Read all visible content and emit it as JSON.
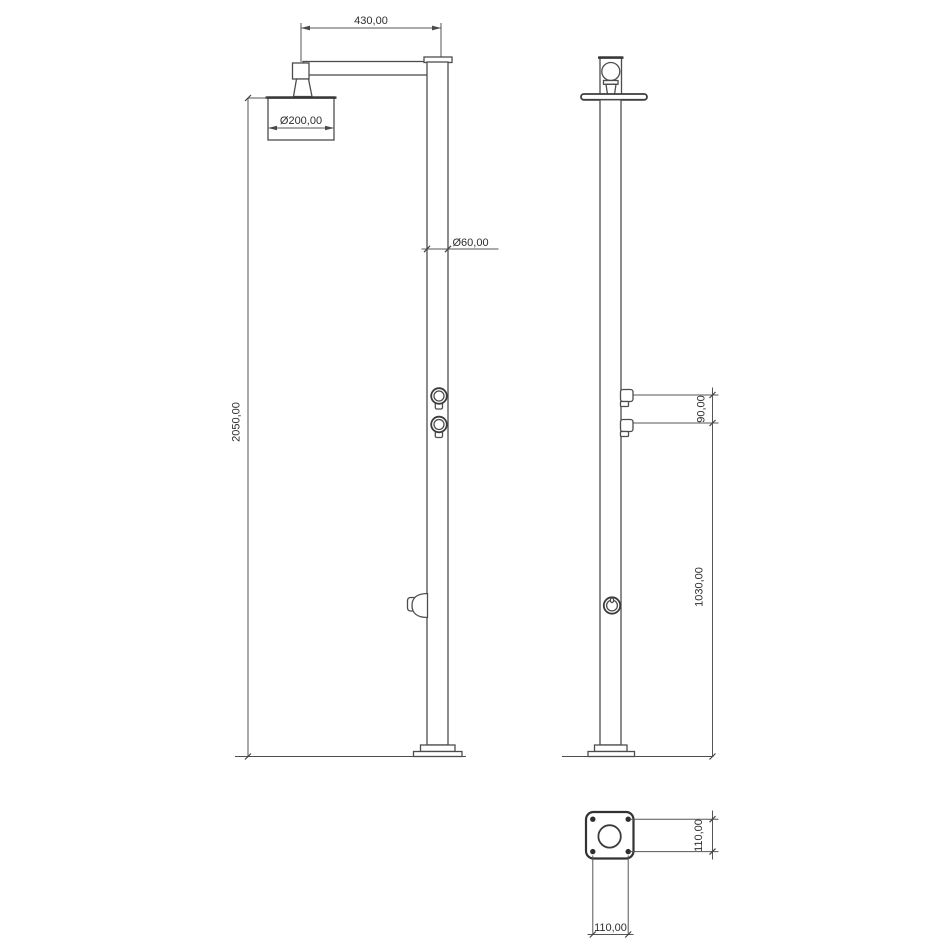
{
  "canvas": {
    "background": "#ffffff",
    "line_color": "#4d4d4d",
    "text_color": "#2e2e2e"
  },
  "dimensions": {
    "arm_length": "430,00",
    "head_diameter": "Ø200,00",
    "pole_diameter": "Ø60,00",
    "total_height": "2050,00",
    "valve_spacing": "90,00",
    "valve_to_base_height": "1030,00",
    "base_plate_height": "110,00",
    "base_plate_width": "110,00"
  }
}
